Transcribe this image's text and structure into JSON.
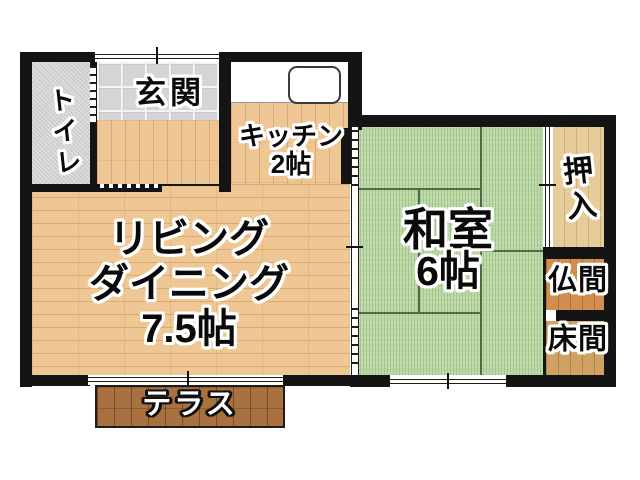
{
  "plan_type": "floor-plan",
  "rooms": {
    "toilet": {
      "name": "トイレ"
    },
    "entrance": {
      "name": "玄関"
    },
    "kitchen": {
      "name": "キッチン",
      "size": "2帖"
    },
    "living_dining": {
      "name_line1": "リビング",
      "name_line2": "ダイニング",
      "size": "7.5帖"
    },
    "japanese_room": {
      "name": "和室",
      "size": "6帖"
    },
    "closet": {
      "name": "押入"
    },
    "buddhist_altar_room": {
      "name": "仏間"
    },
    "tokonoma_alcove": {
      "name": "床間"
    },
    "terrace": {
      "name": "テラス"
    }
  },
  "colors": {
    "wall": "#141414",
    "wood_flooring": "#eec795",
    "tatami_green": "#bcd9a5",
    "tatami_grid_line": "#4c6b47",
    "entrance_tile": "#d5d5d8",
    "toilet_floor": "#e6e6e6",
    "closet_wood": "#e6cb9b",
    "butsuma_wood": "#d28e4e",
    "tokonoma_wood": "#cfa263",
    "terrace_wood": "#a8713f",
    "background": "#ffffff"
  }
}
